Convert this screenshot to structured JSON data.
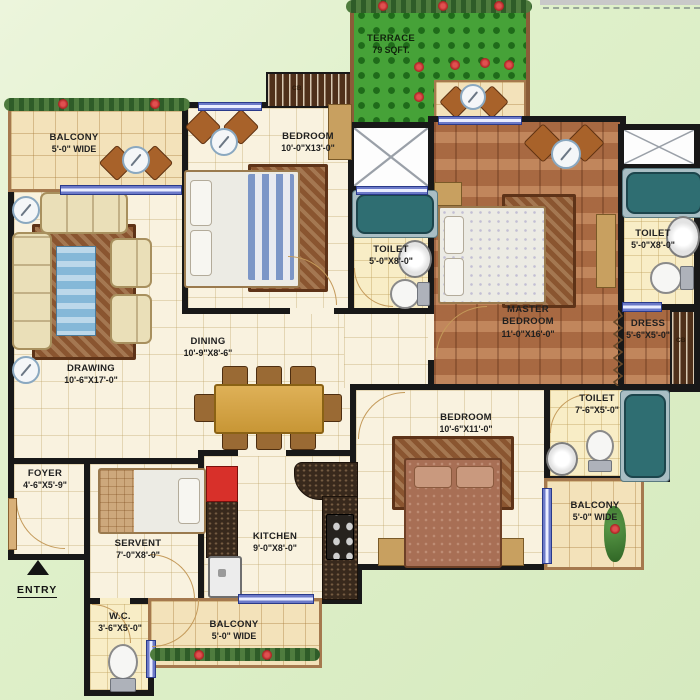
{
  "plan": {
    "title": "Apartment floor plan",
    "entry_label": "ENTRY",
    "cupboard_label": "CB",
    "rooms": {
      "balcony_tl": {
        "name": "BALCONY",
        "dims": "5'-0\" WIDE"
      },
      "bedroom_top": {
        "name": "BEDROOM",
        "dims": "10'-0\"X13'-0\""
      },
      "terrace": {
        "name": "TERRACE",
        "dims": "79 SQFT."
      },
      "toilet_mid": {
        "name": "TOILET",
        "dims": "5'-0\"X8'-0\""
      },
      "master_bedroom": {
        "name": "MASTER BEDROOM",
        "dims": "11'-0\"X16'-0\""
      },
      "toilet_right": {
        "name": "TOILET",
        "dims": "5'-0\"X8'-0\""
      },
      "dress": {
        "name": "DRESS",
        "dims": "5'-6\"X5'-0\""
      },
      "drawing": {
        "name": "DRAWING",
        "dims": "10'-6\"X17'-0\""
      },
      "dining": {
        "name": "DINING",
        "dims": "10'-9\"X8'-6\""
      },
      "toilet_br": {
        "name": "TOILET",
        "dims": "7'-6\"X5'-0\""
      },
      "bedroom_bottom": {
        "name": "BEDROOM",
        "dims": "10'-6\"X11'-0\""
      },
      "balcony_br": {
        "name": "BALCONY",
        "dims": "5'-0\" WIDE"
      },
      "foyer": {
        "name": "FOYER",
        "dims": "4'-6\"X5'-9\""
      },
      "servant": {
        "name": "SERVENT",
        "dims": "7'-0\"X8'-0\""
      },
      "kitchen": {
        "name": "KITCHEN",
        "dims": "9'-0\"X8'-0\""
      },
      "wc": {
        "name": "W.C.",
        "dims": "3'-6\"X5'-0\""
      },
      "balcony_bottom": {
        "name": "BALCONY",
        "dims": "5'-0\" WIDE"
      }
    },
    "colors": {
      "wall": "#181818",
      "tile_floor": "#f9f2df",
      "bath_floor": "#f8edc6",
      "balcony_floor": "#f3e2ba",
      "wood_floor": "#b5744a",
      "terrace_green": "#46a238",
      "window_blue": "#6b79c8",
      "tub_teal": "#2f6e72",
      "accent_red": "#d8302a",
      "outside_green": "#dff0ca"
    }
  }
}
